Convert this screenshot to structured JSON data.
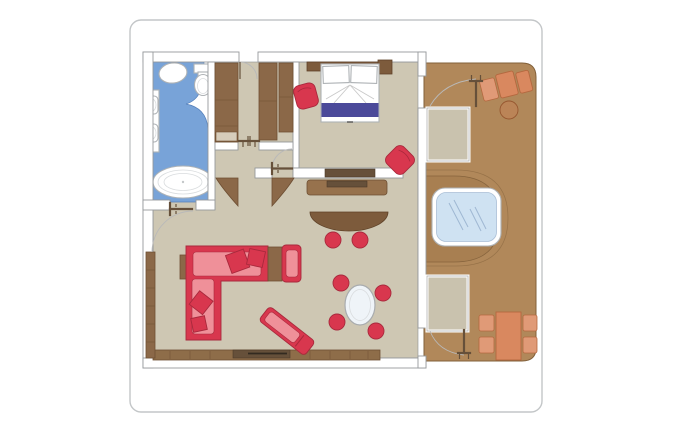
{
  "diagram": {
    "type": "floor-plan",
    "subject": "suite floor plan with terrace and whirlpool",
    "rooms": [
      {
        "id": "bathroom",
        "floor_color": "#78a3d8",
        "fixtures": [
          "shower",
          "toilet",
          "vanity-sink",
          "vanity-sink",
          "bathtub",
          "tub-shelf"
        ]
      },
      {
        "id": "entrance-hall",
        "floor_color": "#cec7b3",
        "fixtures": [
          "wardrobe",
          "wardrobe",
          "wardrobe",
          "double-door",
          "curved-cabinet",
          "curved-cabinet"
        ]
      },
      {
        "id": "bedroom",
        "floor_color": "#cec7b3",
        "fixtures": [
          "headboard",
          "double-bed",
          "pillow",
          "pillow",
          "bed-runner",
          "nightstand",
          "armchair",
          "armchair",
          "tv-console"
        ]
      },
      {
        "id": "living-room",
        "floor_color": "#cec7b3",
        "fixtures": [
          "media-console",
          "curved-bar",
          "bar-stool",
          "bar-stool",
          "l-shaped-sofa",
          "sofa-pillows",
          "end-table",
          "corner-table",
          "armchair",
          "chaise-longue",
          "oval-table",
          "dining-chair",
          "dining-chair",
          "dining-chair",
          "dining-chair",
          "wall-shelf",
          "tv-sideboard"
        ]
      },
      {
        "id": "terrace",
        "floor_color": "#b1885a",
        "fixtures": [
          "sun-lounger",
          "round-side-table",
          "platform",
          "whirlpool",
          "platform",
          "outdoor-table",
          "outdoor-chair",
          "outdoor-chair",
          "outdoor-chair",
          "outdoor-chair"
        ]
      }
    ],
    "doors": [
      "entry-door",
      "bathroom-door",
      "bedroom-door",
      "bedroom-terrace-door",
      "living-terrace-door"
    ],
    "palette": {
      "page_bg": "#ffffff",
      "hull_line": "#c3c6c8",
      "wall_fill": "#ffffff",
      "wall_line": "#96999c",
      "floor_line": "#8d9092",
      "interior_floor": "#cec7b3",
      "bathroom_floor": "#78a3d8",
      "bathroom_line": "#5580bb",
      "deck": "#b1885a",
      "deck_dark": "#a87f51",
      "deck_line": "#82603a",
      "wood": "#8b6848",
      "wood_line": "#6e4f33",
      "wood_dark": "#7d5b3c",
      "wood_mid": "#97724d",
      "wood_deep": "#66503a",
      "band": "#8e6d49",
      "red": "#d8374e",
      "red_light": "#ef9099",
      "red_line": "#a8293c",
      "terracotta": "#d9885f",
      "terracotta_light": "#e09a77",
      "terracotta_line": "#b4683f",
      "purple": "#4b4a9a",
      "water": "#cfe2f2",
      "water_line": "#9fb8d3",
      "fixture_line": "#aeb2b5",
      "arc_line": "#b9b9b9",
      "platform": "#c9c2ae"
    }
  }
}
